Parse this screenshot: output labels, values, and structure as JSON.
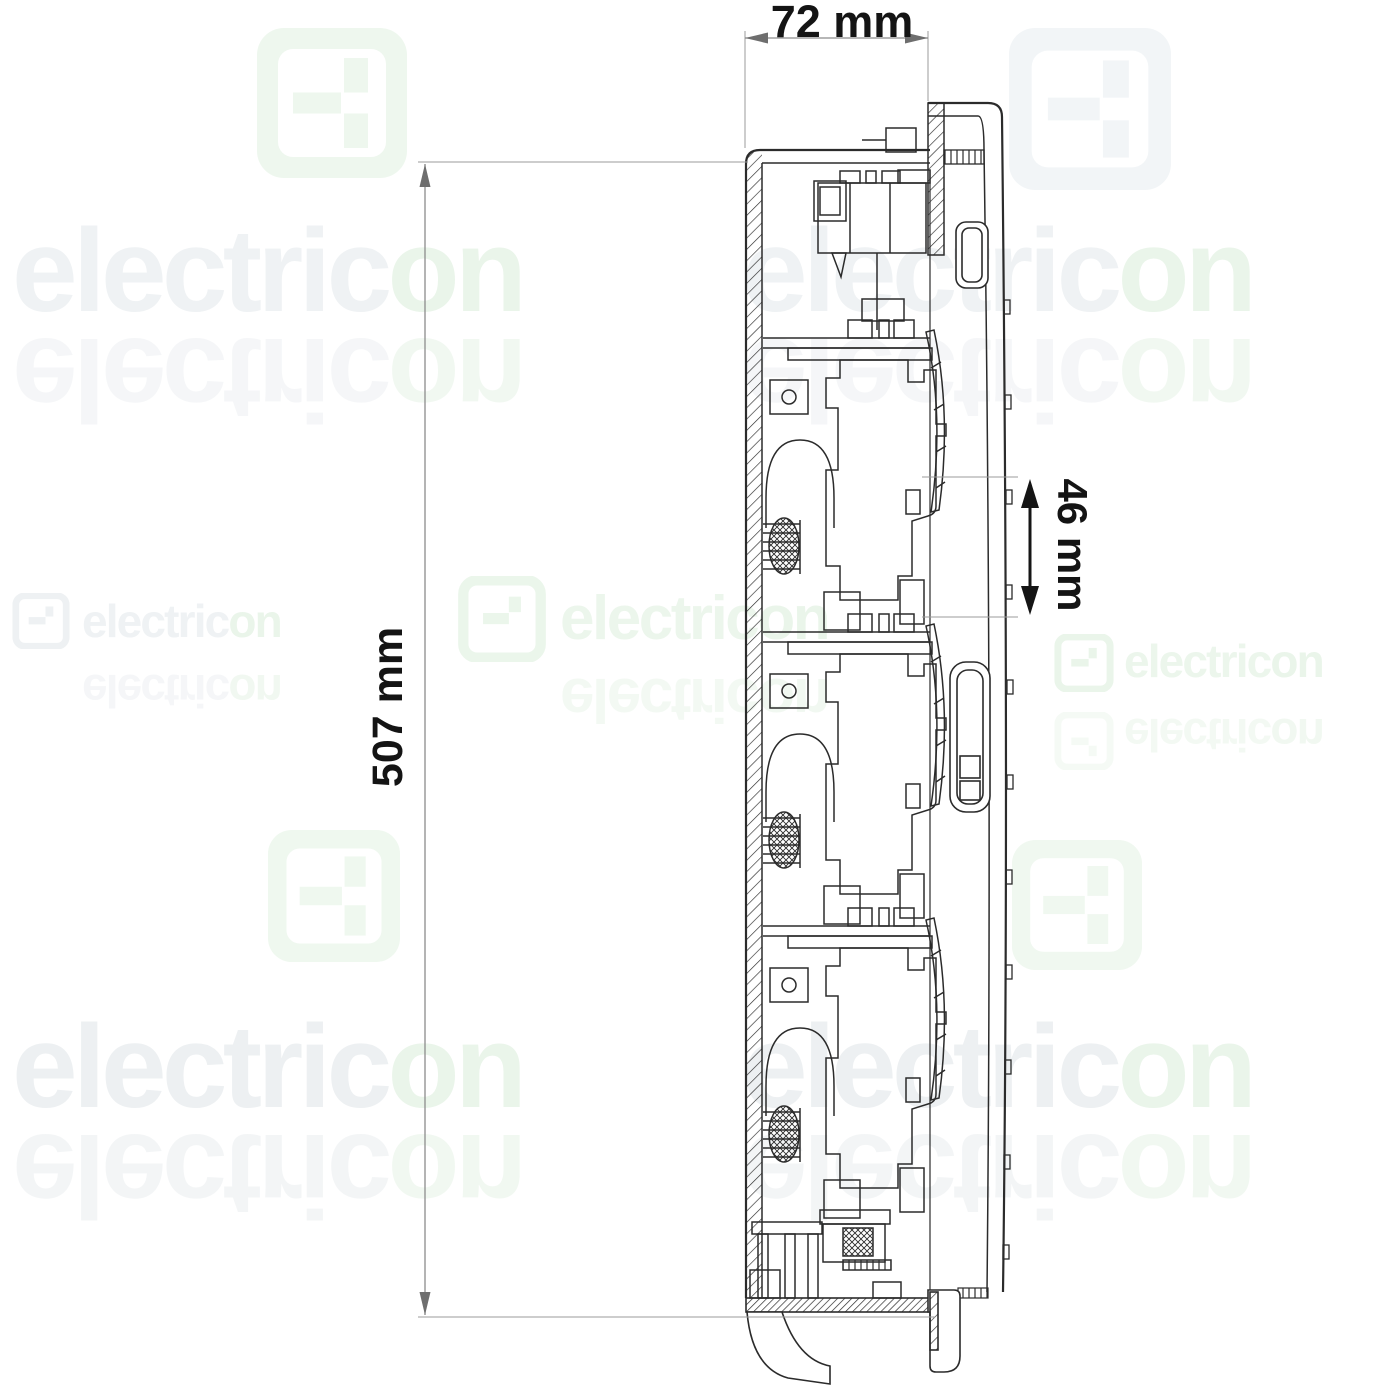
{
  "annotations": {
    "width_label": "72 mm",
    "height_label": "507 mm",
    "spacing_label": "46 mm"
  },
  "watermark": {
    "brand": "electricon",
    "brand_prefix": "electric",
    "brand_suffix": "on",
    "gray_color": "#eff2f4",
    "green_color": "#eaf5ea"
  },
  "drawing": {
    "line_color": "#2b2b2b",
    "dimension_line_color": "#8c8c8c",
    "spacing_arrow_color": "#151515"
  }
}
